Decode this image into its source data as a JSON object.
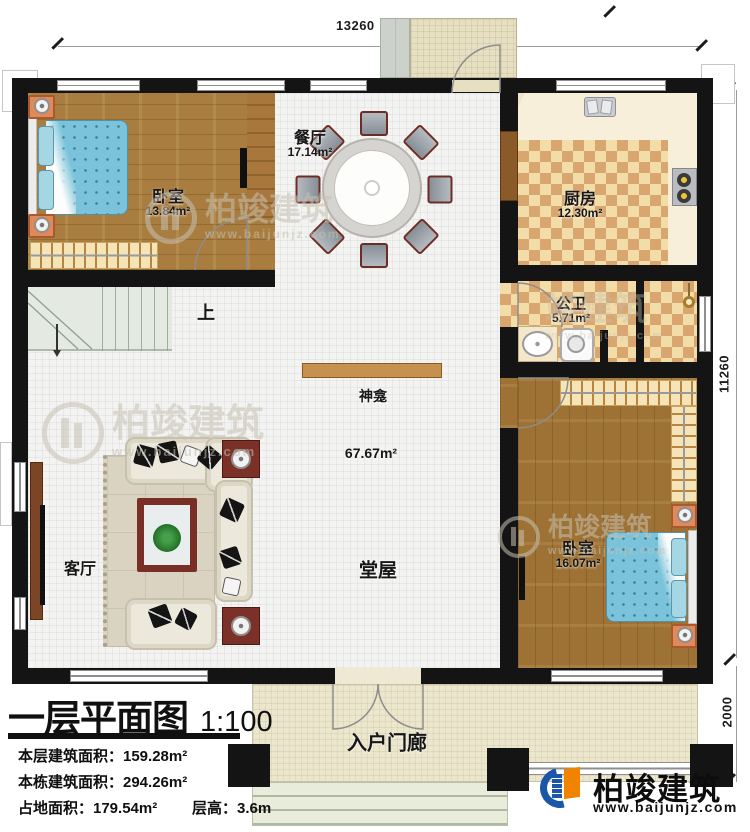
{
  "page": {
    "width": 750,
    "height": 832
  },
  "dimensions": {
    "top": "13260",
    "right": "11260",
    "porch_depth": "2000"
  },
  "rooms": {
    "bedroom_left": {
      "name": "卧室",
      "area": "13.84m²"
    },
    "dining": {
      "name": "餐厅",
      "area": "17.14m²"
    },
    "kitchen": {
      "name": "厨房",
      "area": "12.30m²"
    },
    "bathroom": {
      "name": "公卫",
      "area": "5.71m²"
    },
    "bedroom_right": {
      "name": "卧室",
      "area": "16.07m²"
    },
    "living_room": {
      "name": "客厅"
    },
    "hall": {
      "name": "堂屋",
      "area": "67.67m²"
    },
    "shrine": {
      "name": "神龛"
    },
    "stair": {
      "direction": "上"
    },
    "entry_porch": {
      "name": "入户门廊"
    }
  },
  "title_block": {
    "title": "一层平面图",
    "scale": "1:100",
    "stats": [
      "本层建筑面积：159.28m²",
      "本栋建筑面积：294.26m²",
      "占地面积：179.54m²",
      "层高：3.6m"
    ]
  },
  "branding": {
    "company": "柏竣建筑",
    "website": "www.baijunjz.com",
    "partial_mark": "竣建筑"
  },
  "colors": {
    "wall": "#141414",
    "wood_floor": "#a97d3f",
    "wood_floor_dark": "#9e7234",
    "checker_light": "#f2dca7",
    "checker_dark": "#d9a66f",
    "bed_blue": "#7ac3da",
    "logo_blue": "#1a57a8",
    "logo_orange": "#f08300"
  }
}
